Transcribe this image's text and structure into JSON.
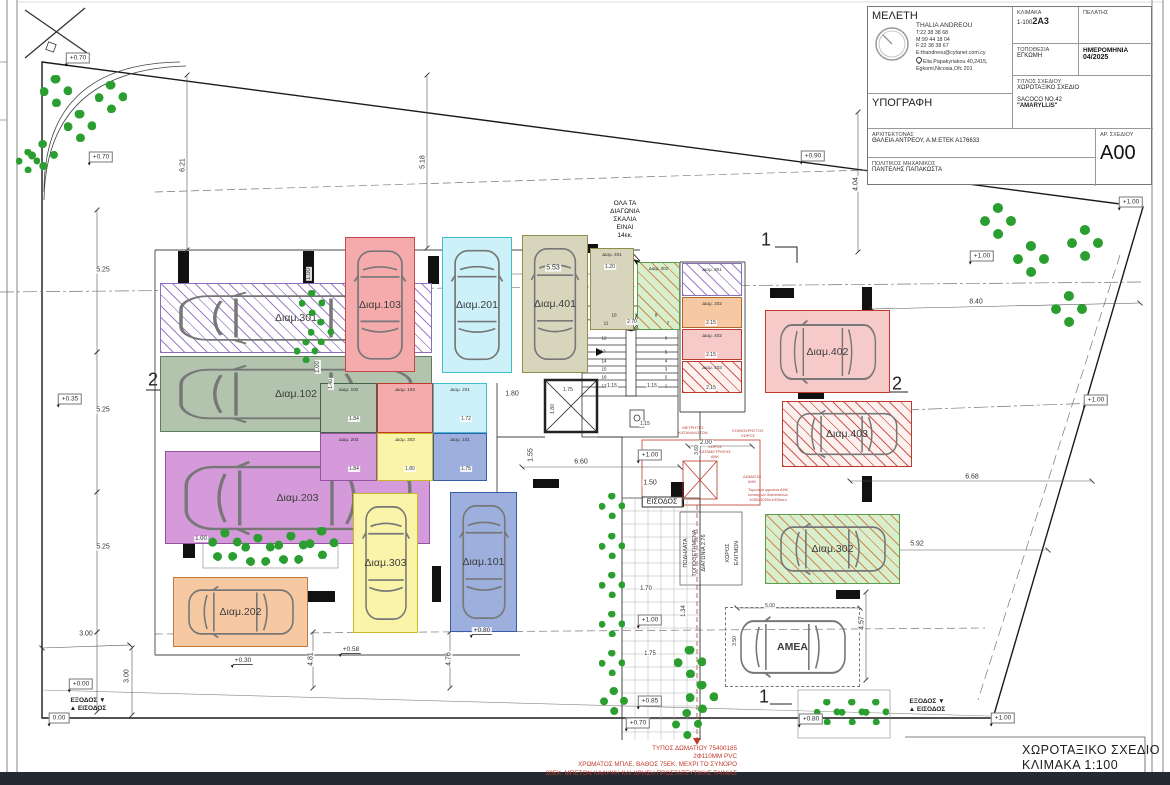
{
  "title_block": {
    "meleti_label": "ΜΕΛΕΤΗ",
    "firm_lines": [
      "THALIA ANDREOU",
      "T:22 38 38 68",
      "M:99 44 18 04",
      "F:22 38 38 67",
      "E:thandreou@cytanet.com.cy",
      "Elia Papakyriakou 40,2415,",
      "Egkomi,Nicosia,Ofc 201"
    ],
    "signature_label": "ΥΠΟΓΡΑΦΗ",
    "scale_label": "ΚΛΙΜΑΚΑ",
    "scale_value": "1-100",
    "scale_overlay": "2A3",
    "client_label": "ΠΕΛΑΤΗΣ",
    "location_label": "ΤΟΠΟΘΕΣΙΑ",
    "location_value": "ΕΓΚΩΜΗ",
    "date_label": "ΗΜΕΡΟΜΗΝΙΑ",
    "date_value": "04/2025",
    "drawing_title_label": "ΤΙΤΛΟΣ ΣΧΕΔΙΟΥ",
    "drawing_title_value": "ΧΩΡΟΤΑΞΙΚΟ ΣΧΕΔΙΟ",
    "project_name": "SACOCO NO.42",
    "project_subname": "\"AMARYLLIS\"",
    "architect_label": "ΑΡΧΙΤΕΚΤΟΝΑΣ",
    "architect_value": "ΘΑΛΕΙΑ ΑΝΤΡΕΟΥ, Α.Μ.ΕΤΕΚ Α176633",
    "engineer_label": "ΠΟΛΙΤΙΚΟΣ ΜΗΧΑΝΙΚΟΣ",
    "engineer_value": "ΠΑΝΤΕΛΗΣ ΠΑΠΑΚΩΣΤΑ",
    "number_label": "ΑΡ. ΣΧΕΔΙΟΥ",
    "number_value": "A00"
  },
  "footer": {
    "title": "ΧΩΡΟΤΑΞΙΚΟ ΣΧΕΔΙΟ",
    "scale": "ΚΛΙΜΑΚΑ 1:100"
  },
  "plan": {
    "parking": [
      {
        "t": "Διαμ.301",
        "x": 160,
        "y": 283,
        "w": 272,
        "h": 70,
        "f": "#ffffff",
        "b": "#8a6fc0",
        "h2": "#9a7fc4",
        "car": "h"
      },
      {
        "t": "Διαμ.102",
        "x": 160,
        "y": 356,
        "w": 272,
        "h": 76,
        "f": "#b2c4ae",
        "b": "#5c7d63",
        "car": "h"
      },
      {
        "t": "Διαμ.203",
        "x": 165,
        "y": 451,
        "w": 265,
        "h": 93,
        "f": "#d49ad9",
        "b": "#9552a0",
        "car": "h"
      },
      {
        "t": "Διαμ.202",
        "x": 173,
        "y": 577,
        "w": 135,
        "h": 70,
        "f": "#f7c9a3",
        "b": "#c07a40",
        "car": "h"
      },
      {
        "t": "Διαμ.103",
        "x": 345,
        "y": 237,
        "w": 70,
        "h": 135,
        "f": "#f5abab",
        "b": "#c44a4a",
        "car": "v"
      },
      {
        "t": "Διαμ.201",
        "x": 442,
        "y": 237,
        "w": 70,
        "h": 136,
        "f": "#cdf1f8",
        "b": "#44bccf",
        "car": "v"
      },
      {
        "t": "Διαμ.401",
        "x": 522,
        "y": 235,
        "w": 66,
        "h": 138,
        "f": "#d8d5bd",
        "b": "#8f8f4b",
        "car": "v"
      },
      {
        "t": "Διαμ.303",
        "x": 353,
        "y": 493,
        "w": 65,
        "h": 140,
        "f": "#f9f4a8",
        "b": "#c9b928",
        "car": "v"
      },
      {
        "t": "Διαμ.101",
        "x": 450,
        "y": 492,
        "w": 67,
        "h": 140,
        "f": "#9dafdc",
        "b": "#3a5ba9",
        "car": "v"
      },
      {
        "t": "Διαμ.402",
        "x": 765,
        "y": 310,
        "w": 125,
        "h": 83,
        "f": "#f7caca",
        "b": "#c0392b",
        "car": "h"
      },
      {
        "t": "Διαμ.403",
        "x": 782,
        "y": 401,
        "w": 130,
        "h": 66,
        "f": "#fdf1f0",
        "b": "#c0392b",
        "h2": "#cc5a4e",
        "car": "h"
      },
      {
        "t": "Διαμ.302",
        "x": 765,
        "y": 514,
        "w": 135,
        "h": 70,
        "f": "#d8eecd",
        "b": "#5a9e52",
        "h2": "#cc8a4a",
        "car": "h"
      },
      {
        "t": "ΑΜΕΑ",
        "x": 725,
        "y": 607,
        "w": 135,
        "h": 80,
        "f": "none",
        "b": "#777777",
        "dash": 1,
        "car": "h"
      }
    ],
    "rooms": [
      {
        "t": "Διαμ. 102",
        "x": 320,
        "y": 383,
        "w": 57,
        "h": 50,
        "f": "#b2c4ae",
        "b": "#44644a"
      },
      {
        "t": "Διαμ. 103",
        "x": 377,
        "y": 383,
        "w": 56,
        "h": 50,
        "f": "#f5abab",
        "b": "#c0392b"
      },
      {
        "t": "Διαμ. 201",
        "x": 433,
        "y": 383,
        "w": 54,
        "h": 50,
        "f": "#cdf1f8",
        "b": "#44bccf"
      },
      {
        "t": "Διαμ. 203",
        "x": 320,
        "y": 433,
        "w": 57,
        "h": 48,
        "f": "#d49ad9",
        "b": "#9552a0"
      },
      {
        "t": "Διαμ. 303",
        "x": 377,
        "y": 433,
        "w": 56,
        "h": 48,
        "f": "#f9f4a8",
        "b": "#c9b928"
      },
      {
        "t": "Διαμ. 101",
        "x": 433,
        "y": 433,
        "w": 54,
        "h": 48,
        "f": "#9dafdc",
        "b": "#3a5ba9"
      },
      {
        "t": "Διαμ. 401",
        "x": 590,
        "y": 248,
        "w": 44,
        "h": 82,
        "f": "#d8d5bd",
        "b": "#8f8f4b"
      },
      {
        "t": "Διαμ. 302",
        "x": 637,
        "y": 262,
        "w": 43,
        "h": 68,
        "f": "#d8eecd",
        "b": "#5a9e52",
        "h2": "#cc8a4a"
      },
      {
        "t": "Διαμ. 301",
        "x": 682,
        "y": 263,
        "w": 60,
        "h": 33,
        "f": "#ffffff",
        "b": "#8a6fc0",
        "h2": "#9a7fc4"
      },
      {
        "t": "Διαμ. 202",
        "x": 682,
        "y": 297,
        "w": 60,
        "h": 31,
        "f": "#f7c9a3",
        "b": "#b06a30"
      },
      {
        "t": "Διαμ. 402",
        "x": 682,
        "y": 329,
        "w": 60,
        "h": 31,
        "f": "#f7caca",
        "b": "#c0392b"
      },
      {
        "t": "Διαμ. 403",
        "x": 682,
        "y": 361,
        "w": 60,
        "h": 32,
        "f": "#fdf1f0",
        "b": "#c0392b",
        "h2": "#cc5a4e"
      }
    ],
    "dims": [
      {
        "t": "6.21",
        "x": 183,
        "y": 165,
        "r": -90
      },
      {
        "t": "5.18",
        "x": 423,
        "y": 162,
        "r": -90
      },
      {
        "t": "5.25",
        "x": 103,
        "y": 270
      },
      {
        "t": "5.25",
        "x": 103,
        "y": 410
      },
      {
        "t": "5.25",
        "x": 103,
        "y": 547
      },
      {
        "t": "3.00",
        "x": 86,
        "y": 634
      },
      {
        "t": "3.00",
        "x": 127,
        "y": 676,
        "r": -90
      },
      {
        "t": "5.53",
        "x": 553,
        "y": 268
      },
      {
        "t": "1.20",
        "x": 610,
        "y": 267,
        "s": 5
      },
      {
        "t": "4.04",
        "x": 856,
        "y": 184,
        "r": -90
      },
      {
        "t": "8.40",
        "x": 976,
        "y": 302
      },
      {
        "t": "6.60",
        "x": 581,
        "y": 462
      },
      {
        "t": "1.50",
        "x": 650,
        "y": 483
      },
      {
        "t": "1.55",
        "x": 531,
        "y": 455,
        "r": -90
      },
      {
        "t": "1.80",
        "x": 512,
        "y": 394
      },
      {
        "t": "1.80",
        "x": 553,
        "y": 409,
        "r": -90,
        "s": 5
      },
      {
        "t": "1.75",
        "x": 568,
        "y": 390,
        "s": 5
      },
      {
        "t": "2.00",
        "x": 706,
        "y": 443,
        "s": 6
      },
      {
        "t": "3.60",
        "x": 697,
        "y": 450,
        "r": -90,
        "s": 5
      },
      {
        "t": "2.70",
        "x": 632,
        "y": 322,
        "s": 5
      },
      {
        "t": "1.15",
        "x": 612,
        "y": 386,
        "s": 5
      },
      {
        "t": "1.15",
        "x": 652,
        "y": 386,
        "s": 5
      },
      {
        "t": "1.15",
        "x": 645,
        "y": 424,
        "s": 5
      },
      {
        "t": "6.68",
        "x": 972,
        "y": 477
      },
      {
        "t": "5.92",
        "x": 917,
        "y": 544
      },
      {
        "t": "4.57",
        "x": 862,
        "y": 623,
        "r": -90
      },
      {
        "t": "5.00",
        "x": 770,
        "y": 606,
        "s": 5
      },
      {
        "t": "3.50",
        "x": 735,
        "y": 641,
        "r": -90,
        "s": 5
      },
      {
        "t": "1.34",
        "x": 684,
        "y": 611,
        "r": -90,
        "s": 6
      },
      {
        "t": "1.70",
        "x": 646,
        "y": 589,
        "s": 6
      },
      {
        "t": "1.75",
        "x": 650,
        "y": 654,
        "s": 6
      },
      {
        "t": "4.81",
        "x": 311,
        "y": 659,
        "r": -90
      },
      {
        "t": "4.76",
        "x": 449,
        "y": 659,
        "r": -90
      },
      {
        "t": "1.00",
        "x": 201,
        "y": 539,
        "s": 6
      },
      {
        "t": "1.00",
        "x": 309,
        "y": 274,
        "r": -90,
        "s": 6
      },
      {
        "t": "1.00",
        "x": 318,
        "y": 367,
        "r": -90,
        "s": 6
      },
      {
        "t": "1.40",
        "x": 331,
        "y": 384,
        "r": -90,
        "s": 5
      },
      {
        "t": "1.84",
        "x": 354,
        "y": 419,
        "s": 5
      },
      {
        "t": "1.84",
        "x": 354,
        "y": 469,
        "s": 5
      },
      {
        "t": "1.72",
        "x": 466,
        "y": 419,
        "s": 5
      },
      {
        "t": "1.80",
        "x": 410,
        "y": 469,
        "s": 5
      },
      {
        "t": "1.75",
        "x": 466,
        "y": 469,
        "s": 5
      },
      {
        "t": "2.15",
        "x": 711,
        "y": 323,
        "s": 5
      },
      {
        "t": "2.15",
        "x": 711,
        "y": 355,
        "s": 5
      },
      {
        "t": "2.15",
        "x": 711,
        "y": 388,
        "s": 5
      }
    ],
    "elevations": [
      {
        "t": "+0.70",
        "x": 78,
        "y": 58,
        "b": 1
      },
      {
        "t": "+0.70",
        "x": 101,
        "y": 157,
        "b": 1
      },
      {
        "t": "+0.90",
        "x": 813,
        "y": 156,
        "b": 1
      },
      {
        "t": "+1.00",
        "x": 1131,
        "y": 202,
        "b": 1
      },
      {
        "t": "+1.00",
        "x": 982,
        "y": 256,
        "b": 1
      },
      {
        "t": "+1.00",
        "x": 1096,
        "y": 400,
        "b": 1
      },
      {
        "t": "+0.35",
        "x": 70,
        "y": 399,
        "b": 1
      },
      {
        "t": "+0.00",
        "x": 81,
        "y": 684,
        "b": 1
      },
      {
        "t": "0.00",
        "x": 59,
        "y": 718,
        "b": 1
      },
      {
        "t": "+0.30",
        "x": 243,
        "y": 661,
        "b": 0
      },
      {
        "t": "+0.58",
        "x": 351,
        "y": 650,
        "b": 0
      },
      {
        "t": "+0.80",
        "x": 482,
        "y": 631,
        "b": 0
      },
      {
        "t": "+1.00",
        "x": 650,
        "y": 455,
        "b": 1
      },
      {
        "t": "+1.00",
        "x": 650,
        "y": 620,
        "b": 1
      },
      {
        "t": "+0.85",
        "x": 650,
        "y": 701,
        "b": 1
      },
      {
        "t": "+0.70",
        "x": 638,
        "y": 723,
        "b": 1
      },
      {
        "t": "+0.80",
        "x": 811,
        "y": 719,
        "b": 1
      },
      {
        "t": "+1.00",
        "x": 1003,
        "y": 718,
        "b": 1
      }
    ],
    "trees": [
      [
        56,
        91,
        16
      ],
      [
        111,
        97,
        16
      ],
      [
        80,
        126,
        16
      ],
      [
        43,
        155,
        15
      ],
      [
        28,
        161,
        12
      ],
      [
        312,
        303,
        13
      ],
      [
        321,
        332,
        13
      ],
      [
        306,
        351,
        12
      ],
      [
        225,
        546,
        17
      ],
      [
        258,
        551,
        17
      ],
      [
        291,
        549,
        17
      ],
      [
        322,
        543,
        16
      ],
      [
        612,
        506,
        13
      ],
      [
        612,
        546,
        13
      ],
      [
        612,
        585,
        13
      ],
      [
        612,
        624,
        13
      ],
      [
        612,
        663,
        13
      ],
      [
        614,
        701,
        14
      ],
      [
        690,
        662,
        16
      ],
      [
        702,
        697,
        16
      ],
      [
        687,
        724,
        15
      ],
      [
        827,
        712,
        13
      ],
      [
        852,
        712,
        13
      ],
      [
        876,
        712,
        13
      ],
      [
        998,
        221,
        18
      ],
      [
        1031,
        259,
        18
      ],
      [
        1085,
        243,
        18
      ],
      [
        1069,
        309,
        18
      ]
    ],
    "sections": [
      {
        "t": "1",
        "x": 766,
        "y": 240
      },
      {
        "t": "1",
        "x": 764,
        "y": 697
      },
      {
        "t": "2",
        "x": 153,
        "y": 380
      },
      {
        "t": "2",
        "x": 897,
        "y": 384
      }
    ],
    "exits": [
      {
        "x": 88,
        "y": 705,
        "lines": [
          "ΕΞΟΔΟΣ ▼",
          "▲ ΕΙΣΟΔΟΣ"
        ]
      },
      {
        "x": 927,
        "y": 706,
        "lines": [
          "ΕΞΟΔΟΣ ▼",
          "▲ ΕΙΣΟΔΟΣ"
        ]
      }
    ],
    "stairs_note": {
      "x": 625,
      "y": 200,
      "lines": [
        "ΟΛΑ ΤΑ",
        "ΔΙΑΓΩΝΙΑ",
        "ΣΚΑΛΙΑ",
        "ΕΙΝΑΙ",
        "14εκ."
      ]
    },
    "stair_numbers": [
      [
        "10",
        614,
        315
      ],
      [
        "9",
        636,
        315
      ],
      [
        "8",
        656,
        315
      ],
      [
        "7",
        668,
        323
      ],
      [
        "11",
        606,
        323
      ],
      [
        "12",
        604,
        338
      ],
      [
        "13",
        603,
        351
      ],
      [
        "14",
        604,
        361
      ],
      [
        "15",
        604,
        369
      ],
      [
        "16",
        604,
        377
      ],
      [
        "17",
        604,
        386
      ],
      [
        "6",
        666,
        338
      ],
      [
        "5",
        666,
        352
      ],
      [
        "4",
        666,
        361
      ],
      [
        "3",
        666,
        369
      ],
      [
        "2",
        666,
        377
      ],
      [
        "1",
        666,
        386
      ]
    ],
    "entrance_label": {
      "t": "ΕΙΣΟΔΟΣ",
      "x": 662,
      "y": 502
    },
    "vtexts": [
      [
        "ΠΟΔΗΛΑΤΑ",
        686,
        553
      ],
      [
        "ΤΟΠΟΘΕΤΗΜΕΝΑ",
        695,
        553
      ],
      [
        "ΔΙΑΓΩΝΙΑ  2.76",
        704,
        553
      ],
      [
        "ΧΩΡΟΣ",
        728,
        553
      ],
      [
        "ΕΛΙΓΜΩΝ",
        737,
        553
      ]
    ],
    "red_notes": [
      {
        "x": 693,
        "y": 431,
        "lines": [
          "ΜΕΤΡΗΤΕΣ",
          "ΚΑΤΑΝΑΛΩΤΩΝ"
        ]
      },
      {
        "x": 748,
        "y": 434,
        "lines": [
          "ΚΟΙΝΟΧΡΗΣΤΟΣ",
          "ΧΩΡΟΣ"
        ]
      },
      {
        "x": 715,
        "y": 452,
        "lines": [
          "ΧΩΡΟΣ",
          "ΚΑΤΑΜΕΤΡΗΣΗΣ",
          "ΑΗΚ"
        ]
      },
      {
        "x": 752,
        "y": 480,
        "lines": [
          "ΔΩΜΑΤΙΟ",
          "ΑΗΚ"
        ]
      },
      {
        "x": 768,
        "y": 495,
        "lines": [
          "Τομωτικά φρεάτια ΑΗΚ",
          "τεσσάρων διαστάσεων",
          "1000x1000x1000mm"
        ]
      }
    ],
    "bottom_red": [
      "ΤΥΠΟΣ ΔΩΜΑΤΙΟΥ 75400185",
      "2Φ110ΜΜ PVC",
      "ΧΡΩΜΑΤΟΣ ΜΠΛΕ, ΒΑΘΟΣ 75ΕΚ. ΜΕΧΡΙ ΤΟ ΣΥΝΟΡΟ",
      "20ΕΚ. ΜΠΕΤΟΝ ΚΑΛΥΨΗ ΚΑΙ ΧΡΗΣΗ ΠΡΟΣΤΑΤΕΥΤΙΚΗΣ ΤΑΙΝΙΑΣ"
    ]
  }
}
